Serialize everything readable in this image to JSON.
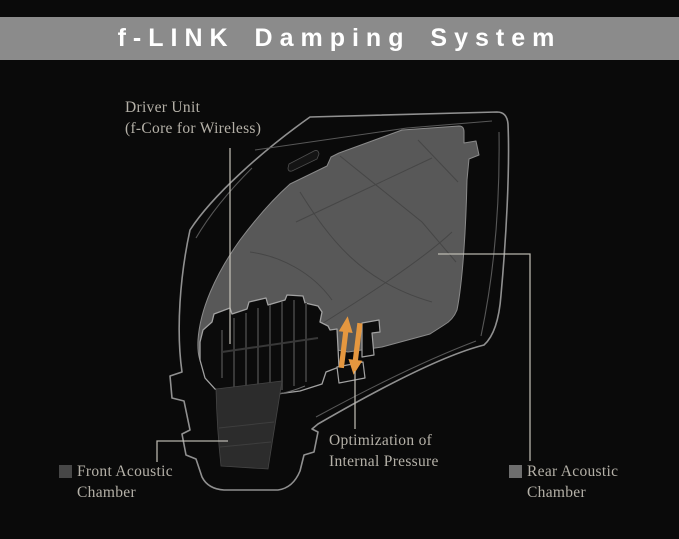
{
  "header": {
    "title": "f-LINK Damping System"
  },
  "diagram": {
    "labels": {
      "driver_unit": {
        "line1": "Driver Unit",
        "line2": "(f-Core for Wireless)"
      },
      "front_chamber": {
        "line1": "Front Acoustic",
        "line2": "Chamber"
      },
      "optimization": {
        "line1": "Optimization of",
        "line2": "Internal Pressure"
      },
      "rear_chamber": {
        "line1": "Rear Acoustic",
        "line2": "Chamber"
      }
    },
    "legend": {
      "front_swatch": "#474747",
      "rear_swatch": "#6e6e6e"
    },
    "colors": {
      "background": "#0a0a0a",
      "banner_bg": "#8b8b8b",
      "banner_text": "#ffffff",
      "label_text": "#b5b1a8",
      "shell_outline": "#909090",
      "rear_chamber_fill": "#585858",
      "front_chamber_fill": "#2c2c2c",
      "driver_fill": "#0b0b0b",
      "arrow_orange": "#e5973f",
      "leader_line": "#c9c5bc"
    }
  }
}
